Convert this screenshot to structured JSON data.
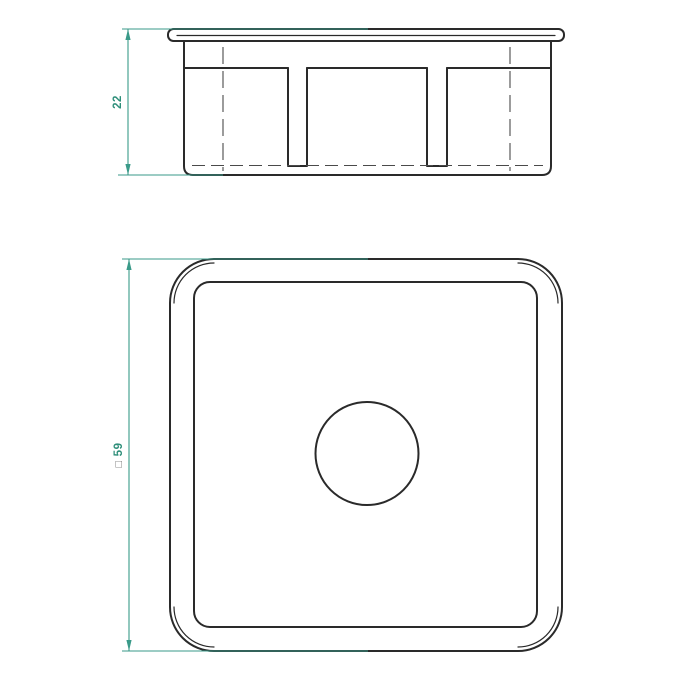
{
  "dims": {
    "side": {
      "value": "22"
    },
    "plan": {
      "symbol": "□",
      "value": "59"
    }
  },
  "colors": {
    "outline": "#2a2a2a",
    "dimension": "#3a9a89",
    "dimension_text": "#2f8f7a",
    "hidden_line": "#4a4a4a",
    "square_symbol": "#6f6f6f",
    "background": "#ffffff"
  }
}
